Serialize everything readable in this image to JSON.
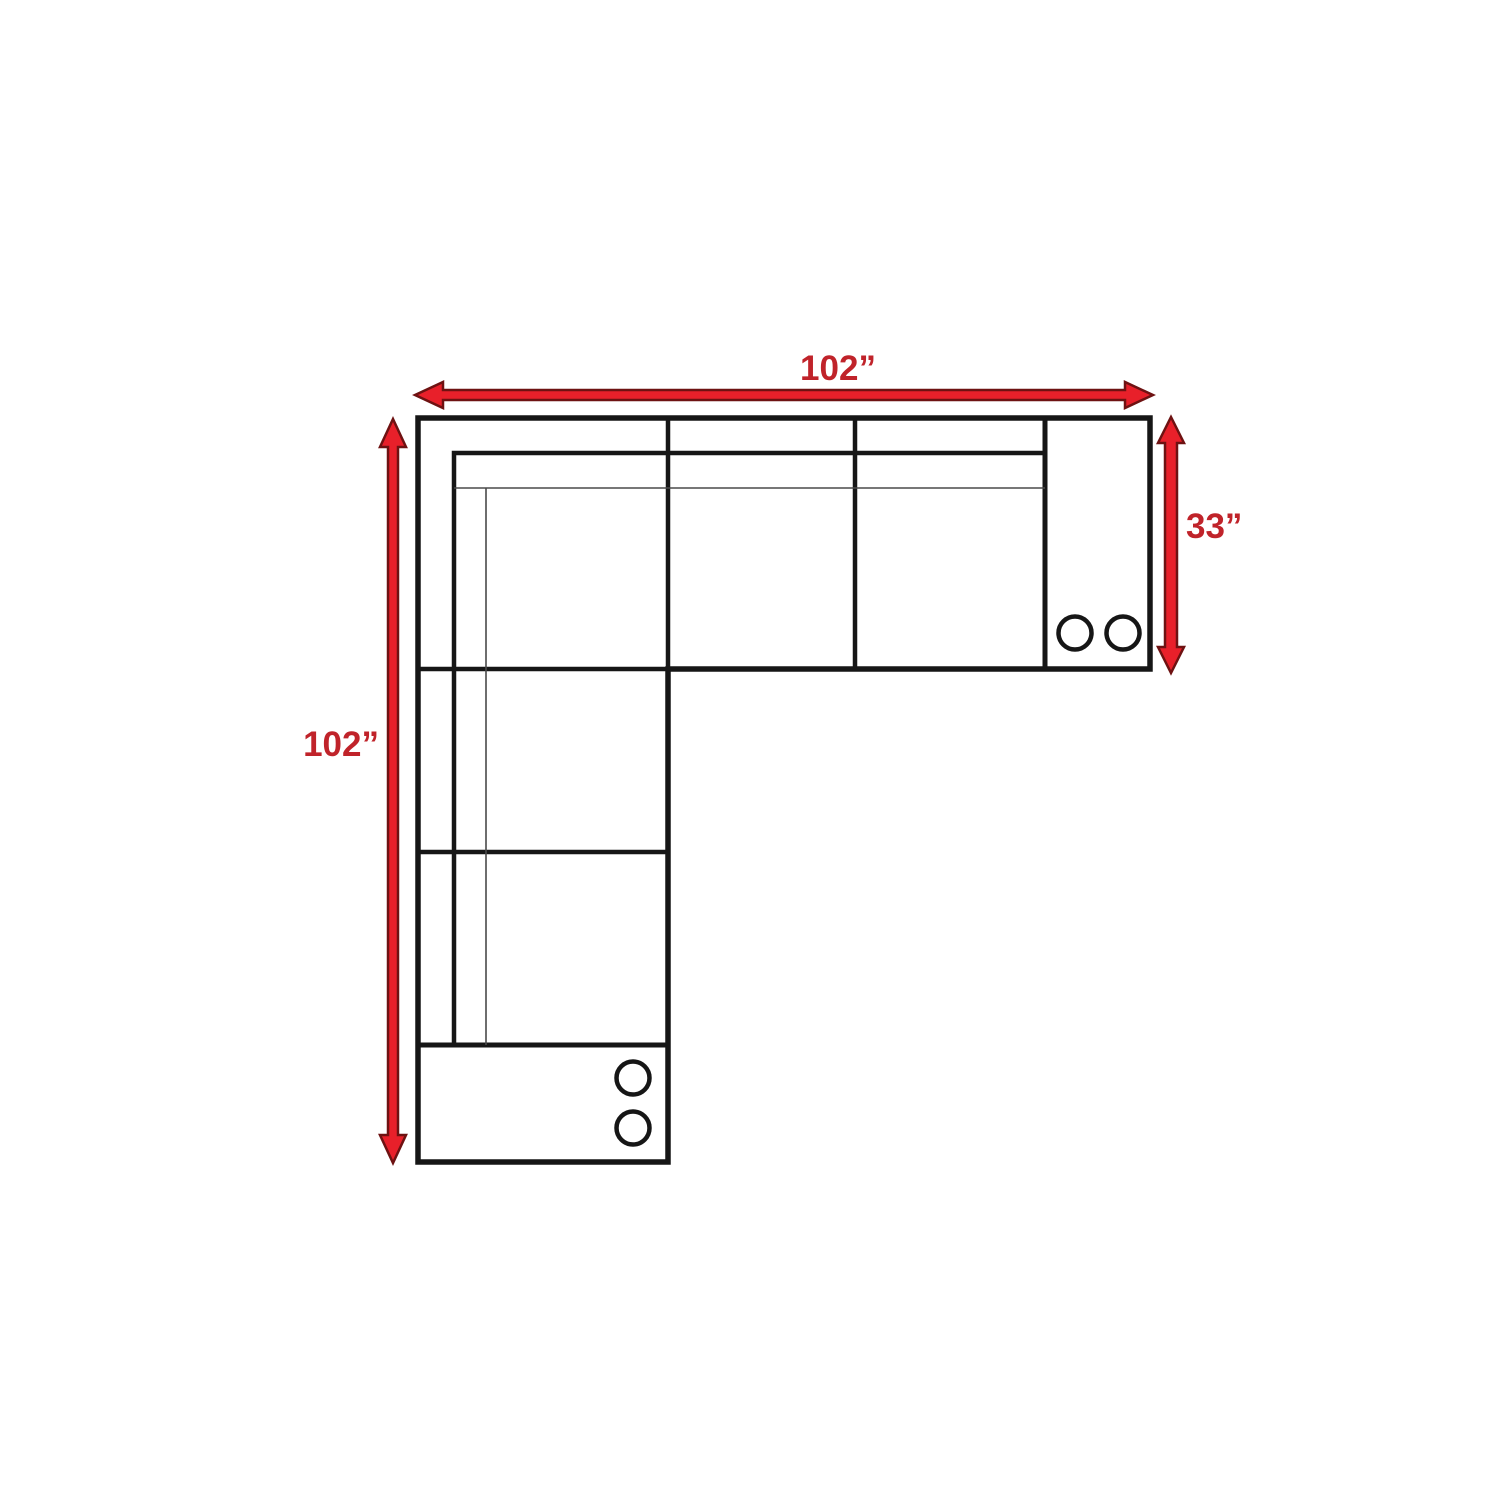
{
  "diagram": {
    "type": "sectional-sofa-floor-plan",
    "dimensions": {
      "top": "102”",
      "left": "102”",
      "right": "33”"
    },
    "consoles": {
      "right_console_cupholders": 2,
      "bottom_console_cupholders": 2
    },
    "colors": {
      "arrow_fill": "#e8202a",
      "arrow_outline": "#6e1212",
      "label": "#c0232a",
      "line": "#161616",
      "thin_line": "#4a4a4a",
      "background": "#ffffff"
    }
  }
}
